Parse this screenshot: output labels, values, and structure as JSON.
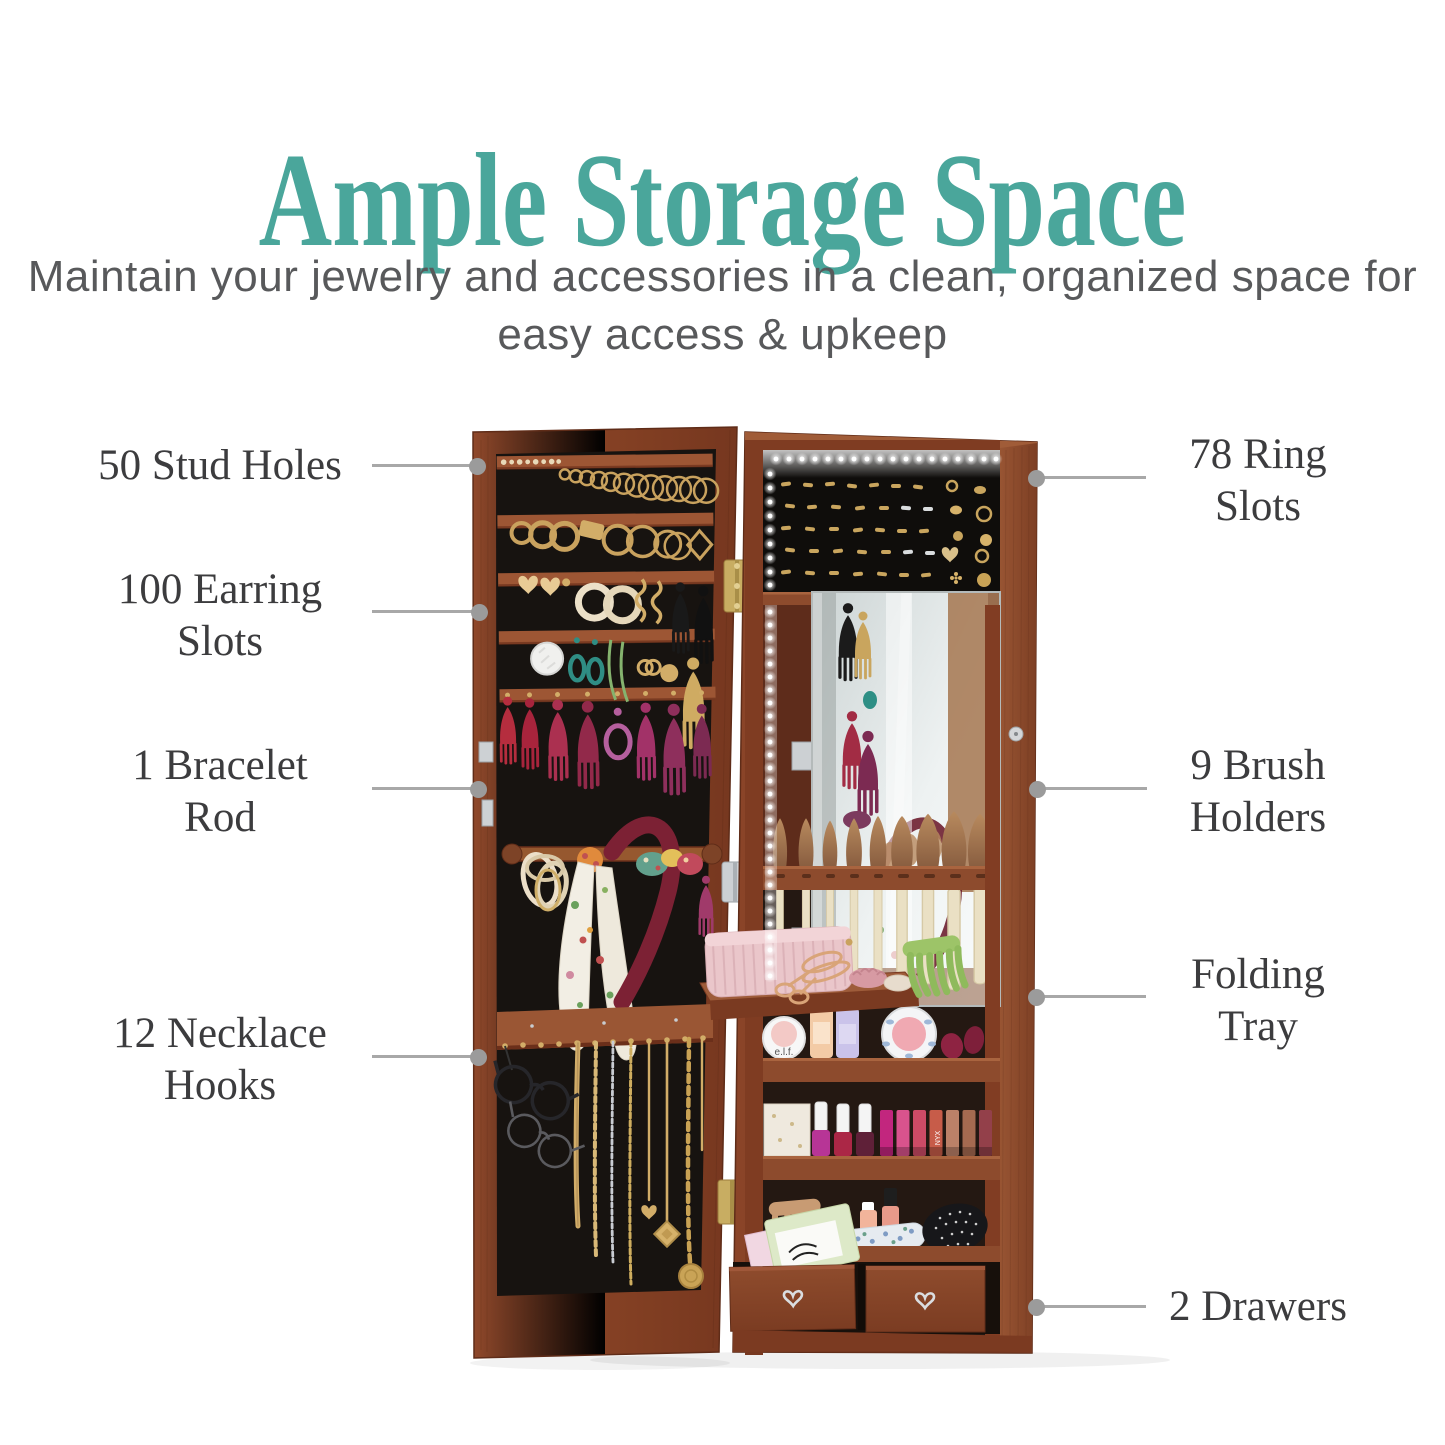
{
  "header": {
    "title": "Ample Storage Space",
    "subtitle_lines": [
      "Maintain your jewelry and accessories in a clean,",
      "organized space for easy access & upkeep"
    ]
  },
  "callouts": {
    "left": [
      {
        "id": "stud-holes",
        "lines": [
          "50 Stud Holes"
        ]
      },
      {
        "id": "earring-slots",
        "lines": [
          "100 Earring",
          "Slots"
        ]
      },
      {
        "id": "bracelet-rod",
        "lines": [
          "1 Bracelet",
          "Rod"
        ]
      },
      {
        "id": "necklace-hooks",
        "lines": [
          "12 Necklace",
          "Hooks"
        ]
      }
    ],
    "right": [
      {
        "id": "ring-slots",
        "lines": [
          "78 Ring",
          "Slots"
        ]
      },
      {
        "id": "brush-holders",
        "lines": [
          "9 Brush",
          "Holders"
        ]
      },
      {
        "id": "folding-tray",
        "lines": [
          "Folding",
          "Tray"
        ]
      },
      {
        "id": "drawers",
        "lines": [
          "2 Drawers"
        ]
      }
    ]
  },
  "product": {
    "description": "Open LED-lit mirrored jewelry armoire with organizer door, ring display, brush holders, folding tray, shelves and drawers",
    "visible_product_text": [
      "e.l.f.",
      "NYX",
      "THE INSTANT MANI"
    ]
  },
  "colors": {
    "accent_teal": "#4aa69b",
    "subtitle_gray": "#58595b",
    "label_gray": "#3c3c3e",
    "callout_line_gray": "#a8a8a8",
    "callout_dot_gray": "#9b9b9b",
    "wood_brown": "#8a4428",
    "felt_black": "#171310",
    "background": "#ffffff"
  }
}
